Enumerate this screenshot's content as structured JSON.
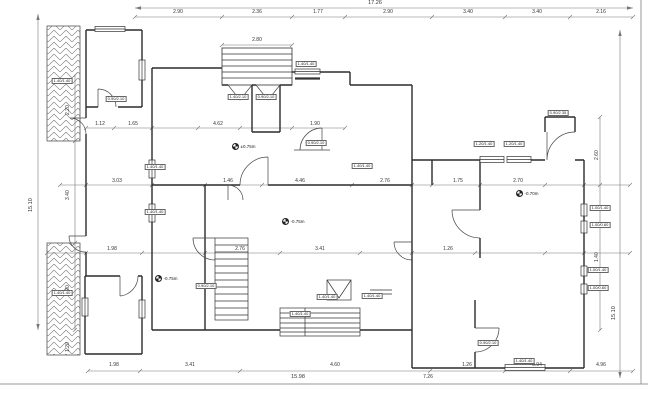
{
  "levels": {
    "upper": "±0.75m",
    "lower_center": "-0.75m",
    "right_room": "-0.70m",
    "left_room": "-0.75m"
  },
  "dims": {
    "top_overall": "17.26",
    "top": [
      "2.90",
      "2.36",
      "1.77",
      "2.90",
      "3.40",
      "3.40",
      "2.16"
    ],
    "stair": "2.80",
    "left_overall": "15.10",
    "left": [
      "2.20",
      "3.40",
      "2.90"
    ],
    "left_small": "1.20",
    "right_overall": "15.10",
    "right": [
      "2.60",
      "1.40"
    ],
    "bottom": [
      "1.98",
      "3.41",
      "4.60",
      "1.26",
      "0.94",
      "4.96"
    ],
    "bottom_overall": "15.98",
    "bottom_extra": "7.26",
    "inner_top": [
      "1.12",
      "1.65",
      "4.62",
      "1.90"
    ],
    "inner_mid": [
      "3.03",
      "1.46",
      "4.46",
      "2.76",
      "1.75",
      "2.70"
    ],
    "inner_low": [
      "1.98",
      "2.76",
      "3.41",
      "1.26"
    ]
  },
  "tags": [
    "0.90/2.10",
    "1.40/1.40",
    "1.40/2.10",
    "0.90/2.10",
    "1.40/1.40",
    "1.40/1.40",
    "0.90/2.10",
    "1.20/1.40",
    "1.20/1.40",
    "0.90/2.35",
    "1.00/1.40",
    "1.00/0.60",
    "1.00/1.40",
    "1.00/0.60",
    "1.40/1.40",
    "0.90/2.10",
    "1.40/1.40",
    "1.40/1.40",
    "1.40/1.40",
    "0.90/2.10",
    "1.40/1.40",
    "1.40/1.40",
    "1.40/1.40"
  ]
}
